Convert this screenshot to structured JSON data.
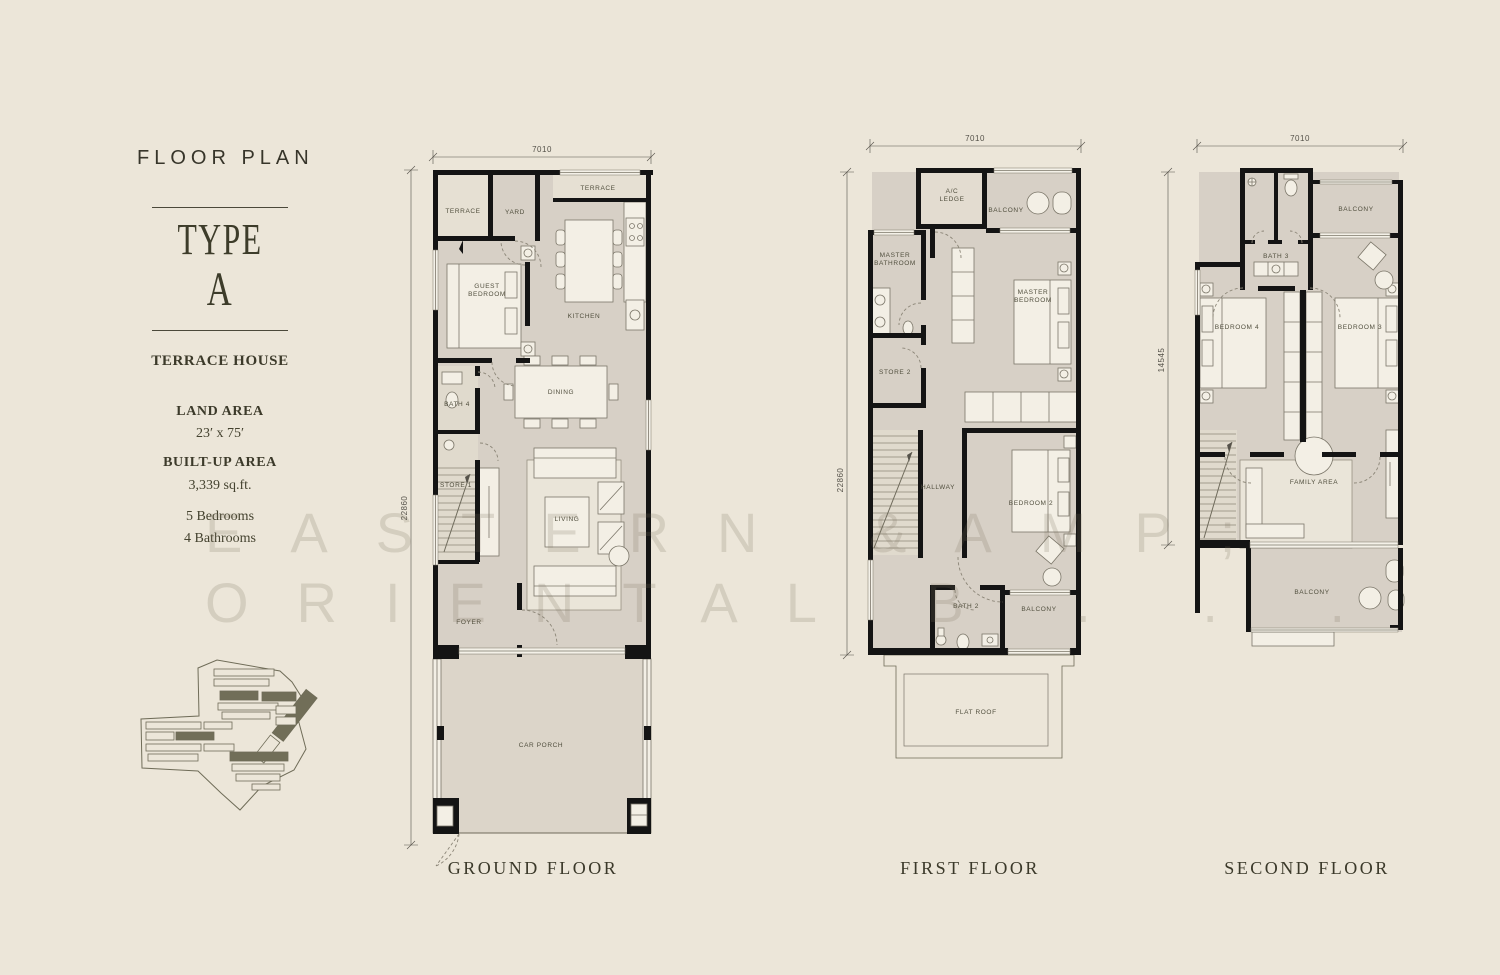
{
  "colors": {
    "background": "#ece6d9",
    "floor": "#d7d0c6",
    "wall": "#141414",
    "accent_text": "#3b392a"
  },
  "sidebar": {
    "title": "FLOOR PLAN",
    "type_label_1": "TYPE",
    "type_label_2": "A",
    "house_type": "TERRACE HOUSE",
    "land_area_label": "LAND AREA",
    "land_area_value": "23′ x 75′",
    "built_up_label": "BUILT-UP AREA",
    "built_up_value": "3,339 sq.ft.",
    "bedrooms": "5 Bedrooms",
    "bathrooms": "4 Bathrooms"
  },
  "watermark": {
    "line1": "EASTERN &AMP;",
    "line2": "ORIENTAL B . . ."
  },
  "plans": {
    "ground": {
      "caption": "GROUND FLOOR",
      "width_dim": "7010",
      "height_dim": "22860",
      "rooms": {
        "terrace_a": "TERRACE",
        "yard": "YARD",
        "terrace_b": "TERRACE",
        "guest_1": "GUEST",
        "guest_2": "BEDROOM",
        "kitchen": "KITCHEN",
        "bath4": "BATH 4",
        "dining": "DINING",
        "store1": "STORE 1",
        "living": "LIVING",
        "foyer": "FOYER",
        "car_porch": "CAR PORCH"
      }
    },
    "first": {
      "caption": "FIRST FLOOR",
      "width_dim": "7010",
      "height_dim": "22860",
      "rooms": {
        "ac_1": "A/C",
        "ac_2": "LEDGE",
        "balcony_top": "BALCONY",
        "mbath_1": "MASTER",
        "mbath_2": "BATHROOM",
        "mbed_1": "MASTER",
        "mbed_2": "BEDROOM",
        "store2": "STORE 2",
        "hallway": "HALLWAY",
        "bedroom2": "BEDROOM 2",
        "bath2": "BATH 2",
        "balcony_bottom": "BALCONY",
        "flat_roof": "FLAT ROOF"
      }
    },
    "second": {
      "caption": "SECOND FLOOR",
      "width_dim": "7010",
      "height_dim": "14545",
      "rooms": {
        "bath3": "BATH 3",
        "balcony_top": "BALCONY",
        "bedroom4": "BEDROOM 4",
        "bedroom3": "BEDROOM 3",
        "family": "FAMILY AREA",
        "balcony_bottom": "BALCONY"
      }
    }
  }
}
